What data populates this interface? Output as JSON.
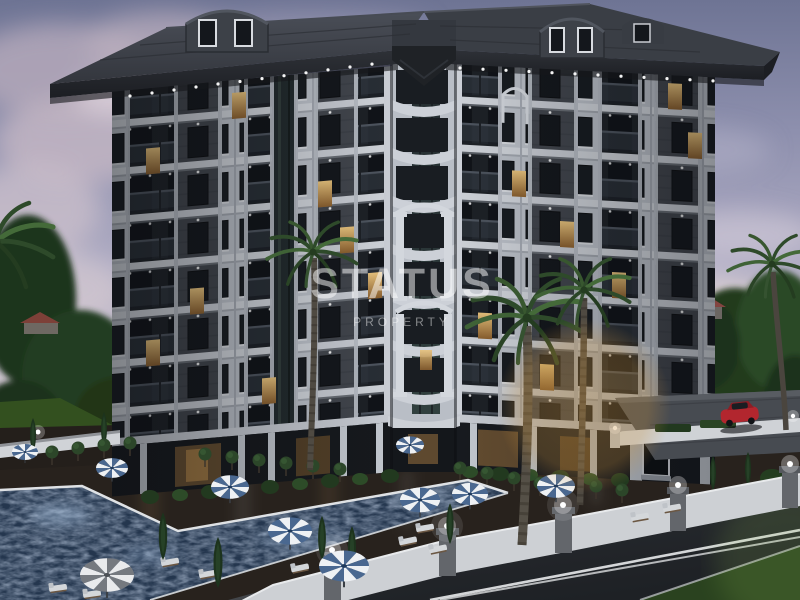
{
  "meta": {
    "alt": "Dusk 3D render of a 9-storey luxury apartment complex with dark roof, white and charcoal facade, lit windows, swimming pool with striped parasols, palm trees, white perimeter fence with lamps, street and red parked car"
  },
  "watermark": {
    "title": "STATUS",
    "subtitle": "PROPERTY"
  },
  "palette": {
    "sky_top": "#6e7494",
    "sky_mid": "#b0adc4",
    "sky_horizon": "#e6dcd6",
    "cloud": "#bfb3c2",
    "roof": "#383c43",
    "roof_fascia": "#24262b",
    "facade_light": "#c2c7cf",
    "facade_shadow": "#9aa0a9",
    "panel_dark": "#41454c",
    "window_glass": "#14171c",
    "window_lit": "#d8b26b",
    "balcony_glass": "#2b3139",
    "pool_water": "#24364e",
    "pool_sparkle": "#9db4cf",
    "deck": "#261f1a",
    "grass": "#2e4527",
    "tree_dark": "#1f331e",
    "palm_green": "#35522e",
    "fence_white": "#d2d5d9",
    "road": "#24272b",
    "road_marking": "#e8eaec",
    "car_red": "#b2262e",
    "umbrella_blue": "#4a6890",
    "umbrella_white": "#eef1f4",
    "gold_tint": "#c89347"
  }
}
